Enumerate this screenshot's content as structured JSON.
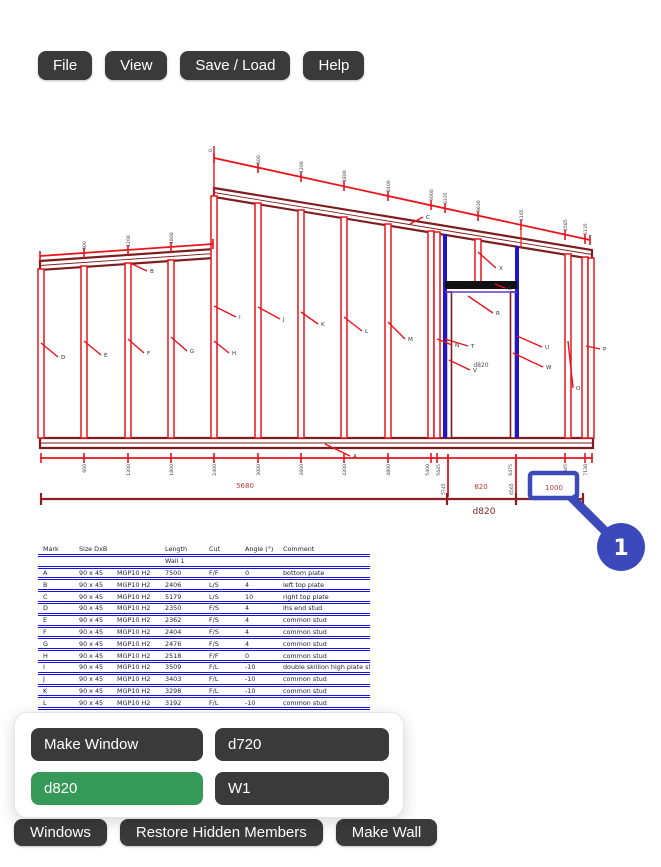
{
  "menu": {
    "items": [
      {
        "label": "File"
      },
      {
        "label": "View"
      },
      {
        "label": "Save / Load"
      },
      {
        "label": "Help"
      }
    ]
  },
  "popup": {
    "buttons": [
      {
        "label": "Make Window",
        "style": "dark"
      },
      {
        "label": "d720",
        "style": "dark"
      },
      {
        "label": "d820",
        "style": "green"
      },
      {
        "label": "W1",
        "style": "dark"
      }
    ]
  },
  "bottom_bar": {
    "buttons": [
      {
        "label": "Windows"
      },
      {
        "label": "Restore Hidden Members"
      },
      {
        "label": "Make Wall"
      }
    ]
  },
  "annotation": {
    "step": "1",
    "highlighted_value": "1000"
  },
  "colors": {
    "red": "#e8131b",
    "dark_red": "#7d1d1d",
    "dim_text_red": "#c03a3a",
    "overall_dim_red": "#8b2020",
    "member_blue": "#1e16c8",
    "header_black": "#111111",
    "sill_purple": "#6b35cc",
    "table_blue": "#1712e8",
    "button_dark": "#3a3a3a",
    "button_green": "#359a58",
    "annot_blue": "#3c49bb",
    "tiny_label": "#3a3a3a"
  },
  "table": {
    "columns": [
      "Mark",
      "Size DxB",
      "",
      "Length",
      "Cut",
      "Angle (°)",
      "Comment"
    ],
    "group_row": "Wall 1",
    "rows": [
      [
        "A",
        "90 x 45",
        "MGP10 H2",
        "7500",
        "F/F",
        "0",
        "bottom plate"
      ],
      [
        "B",
        "90 x 45",
        "MGP10 H2",
        "2406",
        "L/S",
        "4",
        "left top plate"
      ],
      [
        "C",
        "90 x 45",
        "MGP10 H2",
        "5179",
        "L/S",
        "10",
        "right top plate"
      ],
      [
        "D",
        "90 x 45",
        "MGP10 H2",
        "2350",
        "F/S",
        "4",
        "lhs end stud"
      ],
      [
        "E",
        "90 x 45",
        "MGP10 H2",
        "2362",
        "F/S",
        "4",
        "common stud"
      ],
      [
        "F",
        "90 x 45",
        "MGP10 H2",
        "2404",
        "F/S",
        "4",
        "common stud"
      ],
      [
        "G",
        "90 x 45",
        "MGP10 H2",
        "2476",
        "F/S",
        "4",
        "common stud"
      ],
      [
        "H",
        "90 x 45",
        "MGP10 H2",
        "2518",
        "F/F",
        "0",
        "common stud"
      ],
      [
        "I",
        "90 x 45",
        "MGP10 H2",
        "3509",
        "F/L",
        "-10",
        "double skillion high plate stud"
      ],
      [
        "J",
        "90 x 45",
        "MGP10 H2",
        "3403",
        "F/L",
        "-10",
        "common stud"
      ],
      [
        "K",
        "90 x 45",
        "MGP10 H2",
        "3298",
        "F/L",
        "-10",
        "common stud"
      ],
      [
        "L",
        "90 x 45",
        "MGP10 H2",
        "3192",
        "F/L",
        "-10",
        "common stud"
      ],
      [
        "M",
        "90 x 45",
        "MGP10 H2",
        "3086",
        "F/L",
        "-10",
        "common stud"
      ]
    ]
  },
  "drawing": {
    "plates": [
      {
        "name": "bottom-plate",
        "pts": [
          [
            40,
            438
          ],
          [
            593,
            438
          ],
          [
            593,
            448
          ],
          [
            40,
            448
          ]
        ],
        "mid": [
          40,
          443,
          593,
          443
        ]
      },
      {
        "name": "left-top-plate",
        "pts": [
          [
            40,
            261
          ],
          [
            214,
            249
          ],
          [
            214,
            258
          ],
          [
            40,
            270
          ]
        ],
        "mid": [
          40,
          265.5,
          214,
          253.5
        ]
      },
      {
        "name": "right-top-plate",
        "pts": [
          [
            214,
            188
          ],
          [
            592,
            250
          ],
          [
            592,
            259
          ],
          [
            214,
            197
          ]
        ],
        "mid": [
          214,
          192.5,
          592,
          254.5
        ]
      }
    ],
    "studs": [
      {
        "x": 41,
        "y1": 269,
        "y2": 438
      },
      {
        "x": 84,
        "y1": 266,
        "y2": 438
      },
      {
        "x": 128,
        "y1": 263,
        "y2": 438
      },
      {
        "x": 171,
        "y1": 260,
        "y2": 438
      },
      {
        "x": 214,
        "y1": 196,
        "y2": 438
      },
      {
        "x": 258,
        "y1": 203,
        "y2": 438
      },
      {
        "x": 301,
        "y1": 210,
        "y2": 438
      },
      {
        "x": 344,
        "y1": 217,
        "y2": 438
      },
      {
        "x": 388,
        "y1": 224,
        "y2": 438
      },
      {
        "x": 431,
        "y1": 231,
        "y2": 438
      },
      {
        "x": 437,
        "y1": 232,
        "y2": 438
      },
      {
        "x": 478,
        "y1": 239,
        "y2": 282
      },
      {
        "x": 568,
        "y1": 254,
        "y2": 438
      },
      {
        "x": 585,
        "y1": 257,
        "y2": 438
      },
      {
        "x": 591,
        "y1": 258,
        "y2": 438
      }
    ],
    "blue_jambs": [
      {
        "x": 445,
        "y1": 234,
        "y2": 438
      },
      {
        "x": 517,
        "y1": 246,
        "y2": 438
      }
    ],
    "dark_jambs": [
      {
        "x": 449,
        "y1": 292,
        "y2": 438
      },
      {
        "x": 513,
        "y1": 292,
        "y2": 438
      }
    ],
    "window": {
      "header": [
        445,
        281,
        72,
        8
      ],
      "sill": [
        445,
        292,
        517,
        292
      ],
      "label": "d820",
      "label_xy": [
        481,
        367
      ]
    },
    "dimlines": [
      {
        "x1": 40,
        "y1": 256,
        "x2": 213,
        "y2": 244,
        "c": "red",
        "w": 1.8
      },
      {
        "x1": 214,
        "y1": 158,
        "x2": 590,
        "y2": 240,
        "c": "red",
        "w": 1.8
      },
      {
        "x1": 214,
        "y1": 146,
        "x2": 214,
        "y2": 196,
        "c": "red",
        "w": 1.4
      },
      {
        "x1": 521,
        "y1": 228,
        "x2": 521,
        "y2": 248,
        "c": "red",
        "w": 1.2
      },
      {
        "x1": 40,
        "y1": 458,
        "x2": 593,
        "y2": 458,
        "c": "red",
        "w": 1.8
      },
      {
        "x1": 40,
        "y1": 499,
        "x2": 583,
        "y2": 499,
        "c": "overall_dim_red",
        "w": 2.2
      }
    ],
    "ticks": [
      [
        40,
        256
      ],
      [
        84,
        253
      ],
      [
        128,
        250
      ],
      [
        171,
        247
      ],
      [
        213,
        244
      ],
      [
        214,
        158
      ],
      [
        258,
        168
      ],
      [
        301,
        177
      ],
      [
        344,
        186
      ],
      [
        388,
        196
      ],
      [
        431,
        205
      ],
      [
        445,
        208
      ],
      [
        478,
        216
      ],
      [
        521,
        225
      ],
      [
        565,
        235
      ],
      [
        585,
        239
      ],
      [
        590,
        240
      ],
      [
        41,
        458
      ],
      [
        84,
        458
      ],
      [
        128,
        458
      ],
      [
        171,
        458
      ],
      [
        214,
        458
      ],
      [
        258,
        458
      ],
      [
        301,
        458
      ],
      [
        344,
        458
      ],
      [
        388,
        458
      ],
      [
        431,
        458
      ],
      [
        437,
        458
      ],
      [
        565,
        458
      ],
      [
        585,
        458
      ],
      [
        592,
        458
      ]
    ],
    "long_ticks": [
      [
        448,
        454,
        497
      ],
      [
        516,
        454,
        497
      ]
    ],
    "dark_ticks": [
      [
        41,
        499
      ],
      [
        447,
        499
      ],
      [
        516,
        499
      ],
      [
        583,
        499
      ]
    ],
    "rot_labels": [
      {
        "t": "600",
        "x": 86,
        "y": 250,
        "a": "s"
      },
      {
        "t": "1200",
        "x": 130,
        "y": 247,
        "a": "s"
      },
      {
        "t": "1800",
        "x": 173,
        "y": 244,
        "a": "s"
      },
      {
        "t": "0",
        "x": 212,
        "y": 152,
        "a": "s"
      },
      {
        "t": "600",
        "x": 260,
        "y": 164,
        "a": "s"
      },
      {
        "t": "1200",
        "x": 303,
        "y": 173,
        "a": "s"
      },
      {
        "t": "1800",
        "x": 346,
        "y": 182,
        "a": "s"
      },
      {
        "t": "2400",
        "x": 390,
        "y": 192,
        "a": "s"
      },
      {
        "t": "3000",
        "x": 433,
        "y": 201,
        "a": "s"
      },
      {
        "t": "3335",
        "x": 447,
        "y": 204,
        "a": "s"
      },
      {
        "t": "3630",
        "x": 480,
        "y": 212,
        "a": "s"
      },
      {
        "t": "4165",
        "x": 523,
        "y": 221,
        "a": "s"
      },
      {
        "t": "4585",
        "x": 567,
        "y": 231,
        "a": "s"
      },
      {
        "t": "5135",
        "x": 587,
        "y": 235,
        "a": "s"
      },
      {
        "t": "600",
        "x": 86,
        "y": 464,
        "a": "e"
      },
      {
        "t": "1200",
        "x": 130,
        "y": 464,
        "a": "e"
      },
      {
        "t": "1800",
        "x": 173,
        "y": 464,
        "a": "e"
      },
      {
        "t": "2400",
        "x": 216,
        "y": 464,
        "a": "e"
      },
      {
        "t": "3000",
        "x": 260,
        "y": 464,
        "a": "e"
      },
      {
        "t": "3600",
        "x": 303,
        "y": 464,
        "a": "e"
      },
      {
        "t": "4200",
        "x": 346,
        "y": 464,
        "a": "e"
      },
      {
        "t": "4800",
        "x": 390,
        "y": 464,
        "a": "e"
      },
      {
        "t": "5400",
        "x": 429,
        "y": 464,
        "a": "e"
      },
      {
        "t": "5645",
        "x": 440,
        "y": 464,
        "a": "e"
      },
      {
        "t": "6475",
        "x": 512,
        "y": 464,
        "a": "e"
      },
      {
        "t": "7045",
        "x": 567,
        "y": 464,
        "a": "e"
      },
      {
        "t": "7130",
        "x": 587,
        "y": 464,
        "a": "e"
      },
      {
        "t": "5745",
        "x": 445,
        "y": 495,
        "a": "s"
      },
      {
        "t": "6565",
        "x": 513,
        "y": 495,
        "a": "s"
      }
    ],
    "dim_texts": [
      {
        "t": "5680",
        "x": 245,
        "y": 488,
        "s": 7,
        "c": "dim_text_red"
      },
      {
        "t": "820",
        "x": 481,
        "y": 489,
        "s": 7,
        "c": "dim_text_red"
      },
      {
        "t": "d820",
        "x": 484,
        "y": 514,
        "s": 9,
        "c": "overall_dim_red"
      }
    ],
    "leaders": [
      {
        "t": "A",
        "x1": 325,
        "y1": 444,
        "x2": 350,
        "y2": 456
      },
      {
        "t": "B",
        "x1": 130,
        "y1": 263,
        "x2": 147,
        "y2": 271
      },
      {
        "t": "C",
        "x1": 410,
        "y1": 224,
        "x2": 423,
        "y2": 217
      },
      {
        "t": "D",
        "x1": 41,
        "y1": 343,
        "x2": 58,
        "y2": 357
      },
      {
        "t": "E",
        "x1": 84,
        "y1": 341,
        "x2": 101,
        "y2": 355
      },
      {
        "t": "F",
        "x1": 128,
        "y1": 339,
        "x2": 144,
        "y2": 353
      },
      {
        "t": "G",
        "x1": 171,
        "y1": 337,
        "x2": 187,
        "y2": 351
      },
      {
        "t": "H",
        "x1": 214,
        "y1": 341,
        "x2": 229,
        "y2": 353
      },
      {
        "t": "I",
        "x1": 214,
        "y1": 306,
        "x2": 236,
        "y2": 317
      },
      {
        "t": "J",
        "x1": 258,
        "y1": 307,
        "x2": 280,
        "y2": 319
      },
      {
        "t": "K",
        "x1": 301,
        "y1": 312,
        "x2": 318,
        "y2": 324
      },
      {
        "t": "L",
        "x1": 344,
        "y1": 317,
        "x2": 362,
        "y2": 331
      },
      {
        "t": "M",
        "x1": 388,
        "y1": 322,
        "x2": 405,
        "y2": 339
      },
      {
        "t": "N",
        "x1": 437,
        "y1": 339,
        "x2": 452,
        "y2": 345
      },
      {
        "t": "T",
        "x1": 445,
        "y1": 339,
        "x2": 468,
        "y2": 346
      },
      {
        "t": "V",
        "x1": 449,
        "y1": 360,
        "x2": 470,
        "y2": 370
      },
      {
        "t": "X",
        "x1": 478,
        "y1": 252,
        "x2": 496,
        "y2": 268
      },
      {
        "t": "S",
        "x1": 495,
        "y1": 284,
        "x2": 505,
        "y2": 288
      },
      {
        "t": "R",
        "x1": 468,
        "y1": 296,
        "x2": 493,
        "y2": 313
      },
      {
        "t": "U",
        "x1": 517,
        "y1": 336,
        "x2": 542,
        "y2": 347
      },
      {
        "t": "W",
        "x1": 513,
        "y1": 353,
        "x2": 543,
        "y2": 367
      },
      {
        "t": "O",
        "x1": 568,
        "y1": 341,
        "x2": 573,
        "y2": 388
      },
      {
        "t": "P",
        "x1": 586,
        "y1": 346,
        "x2": 600,
        "y2": 349
      }
    ],
    "annot": {
      "box": [
        530,
        473,
        47,
        25
      ],
      "value_xy": [
        554,
        490
      ],
      "line": [
        571,
        497,
        612,
        538
      ],
      "circle": [
        621,
        547,
        24
      ],
      "step_xy": [
        621,
        555
      ]
    }
  }
}
